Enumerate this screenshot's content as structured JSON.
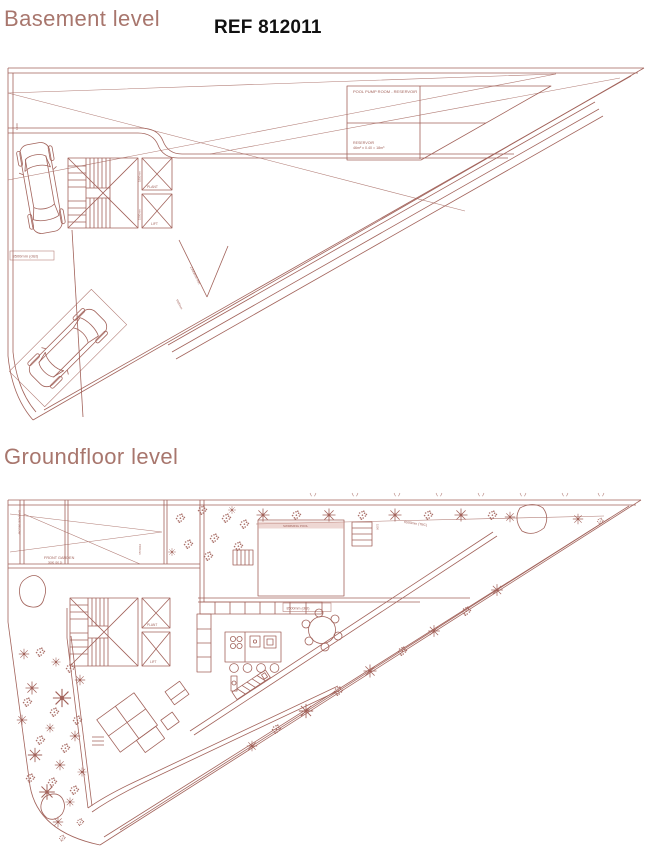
{
  "colors": {
    "bg": "#ffffff",
    "line": "#a2635b",
    "title": "#a8766d",
    "ref_text": "#111111",
    "pool_fill": "#f3ded9",
    "pool_stripe": "#d9a69d"
  },
  "header": {
    "basement_title": "Basement level",
    "ref": "REF 812011"
  },
  "sections": {
    "groundfloor_title": "Groundfloor level"
  },
  "basement": {
    "labels": {
      "pool_pump_room": "POOL PUMP ROOM - RESERVOIR",
      "reservoir_title": "RESERVOIR",
      "reservoir_calc": "46m² x 0.40 = 18m³",
      "dim_8500": "8500mm (dist)",
      "plant_shaft": "PLANT",
      "lift_shaft": "LIFT",
      "dim_1800": "1800mm",
      "dim_1500": "1500mm",
      "ramp_note": "2300mm min",
      "edge_dim": "1500",
      "bay_dim": "5500mm"
    }
  },
  "groundfloor": {
    "labels": {
      "front_garden": "FRONT GARDEN",
      "front_garden_sub": "3080 (50.5)",
      "garage_below": "GARAGE BELOW",
      "swimming_pool": "SWIMMING POOL",
      "dim_8500": "8500mm (dist)",
      "dim_6500": "6500mm (TBC)",
      "dim_1500": "1500mm",
      "steps_dim": "1500",
      "lift_shaft": "LIFT",
      "plant_shaft": "PLANT"
    }
  }
}
